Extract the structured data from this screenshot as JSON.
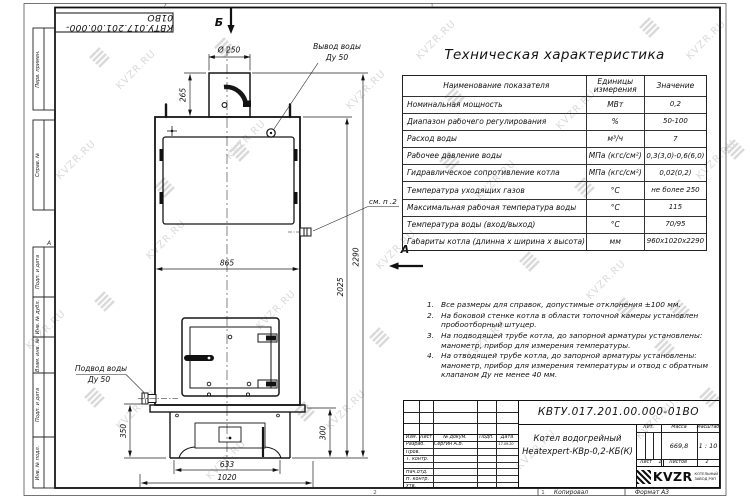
{
  "page": {
    "watermark": "KVZR.RU",
    "copied_label": "Копировал",
    "format_label": "Формат А3",
    "strip_sheet_no": "1",
    "zone_top_left": "2",
    "zone_top_right": "1",
    "zone_bottom_left": "2",
    "zone_bottom_right": "1"
  },
  "frame_labels": {
    "perv_primen": "Перв. примен.",
    "sprav_no": "Справ. №",
    "podp_data_1": "Подп. и дата",
    "inv_dubl": "Инв. № дубл.",
    "vzam_inv": "Взам. инв. №",
    "podp_data_2": "Подп. и дата",
    "inv_podl": "Инв. № подл.",
    "zone_a": "А",
    "doc_number_top": "КВТУ.017.201.00.000-01ВО"
  },
  "spec_table": {
    "title": "Техническая характеристика",
    "headers": [
      "Наименование показателя",
      "Единицы измерения",
      "Значение"
    ],
    "rows": [
      [
        "Номинальная мощность",
        "МВт",
        "0,2"
      ],
      [
        "Диапазон рабочего регулирования",
        "%",
        "50-100"
      ],
      [
        "Расход воды",
        "м³/ч",
        "7"
      ],
      [
        "Рабочее давление воды",
        "МПа (кгс/см²)",
        "0,3(3,0)-0,6(6,0)"
      ],
      [
        "Гидравлическое сопротивление котла",
        "МПа (кгс/см²)",
        "0,02(0,2)"
      ],
      [
        "Температура уходящих газов",
        "°С",
        "не более 250"
      ],
      [
        "Максимальная рабочая температура воды",
        "°С",
        "115"
      ],
      [
        "Температура воды (вход/выход)",
        "°С",
        "70/95"
      ],
      [
        "Габариты котла (длинна х ширина х высота)",
        "мм",
        "960х1020х2290"
      ]
    ]
  },
  "notes": [
    "Все размеры для справок, допустимые отклонения ±100 мм.",
    "На боковой стенке котла в области топочной камеры установлен пробоотборный штуцер.",
    "На подводящей трубе котла, до запорной арматуры установлены: манометр, прибор для измерения температуры.",
    "На отводящей трубе котла, до запорной арматуры установлены: манометр, прибор для измерения температуры и отвод с обратным клапаном Ду не менее 40 мм."
  ],
  "drawing": {
    "view_b": "Б",
    "view_a": "А",
    "dia": "Ø 250",
    "d265": "265",
    "d865": "865",
    "d2025": "2025",
    "d2290": "2290",
    "d350": "350",
    "d300": "300",
    "d633": "633",
    "d1020": "1020",
    "outlet1": "Вывод воды",
    "outlet2": "Ду 50",
    "inlet1": "Подвод воды",
    "inlet2": "Ду 50",
    "see_note": "см. п .2"
  },
  "title_block": {
    "doc_number": "КВТУ.017.201.00.000-01ВО",
    "name_line1": "Котел водогрейный",
    "name_line2": "Heatexpert-КВр-0,2-КБ(К)",
    "cols": {
      "izm": "Изм.",
      "list": "Лист",
      "doc": "№ докум.",
      "sign": "Подп.",
      "date": "Дата"
    },
    "sign_rows": [
      {
        "role": "Разраб.",
        "name": "Сергин А.В.",
        "sign": "",
        "date": "17.09.20"
      },
      {
        "role": "Пров.",
        "name": "",
        "sign": "",
        "date": ""
      },
      {
        "role": "Т. контр.",
        "name": "",
        "sign": "",
        "date": ""
      },
      {
        "role": "",
        "name": "",
        "sign": "",
        "date": ""
      },
      {
        "role": "Нач.отд.",
        "name": "",
        "sign": "",
        "date": ""
      },
      {
        "role": "Н. контр.",
        "name": "",
        "sign": "",
        "date": ""
      },
      {
        "role": "Утв.",
        "name": "",
        "sign": "",
        "date": ""
      }
    ],
    "lit_label": "Лит.",
    "mass_label": "Масса",
    "scale_label": "Масштаб",
    "mass_value": "669,8",
    "scale_value": "1 : 10",
    "sheet_label": "Лист",
    "sheet_value": "1",
    "sheets_label": "Листов",
    "sheets_value": "2",
    "brand": "KVZR",
    "brand_line1": "КОТЕЛЬНЫЙ",
    "brand_line2": "ЗАВОД РЭП"
  }
}
